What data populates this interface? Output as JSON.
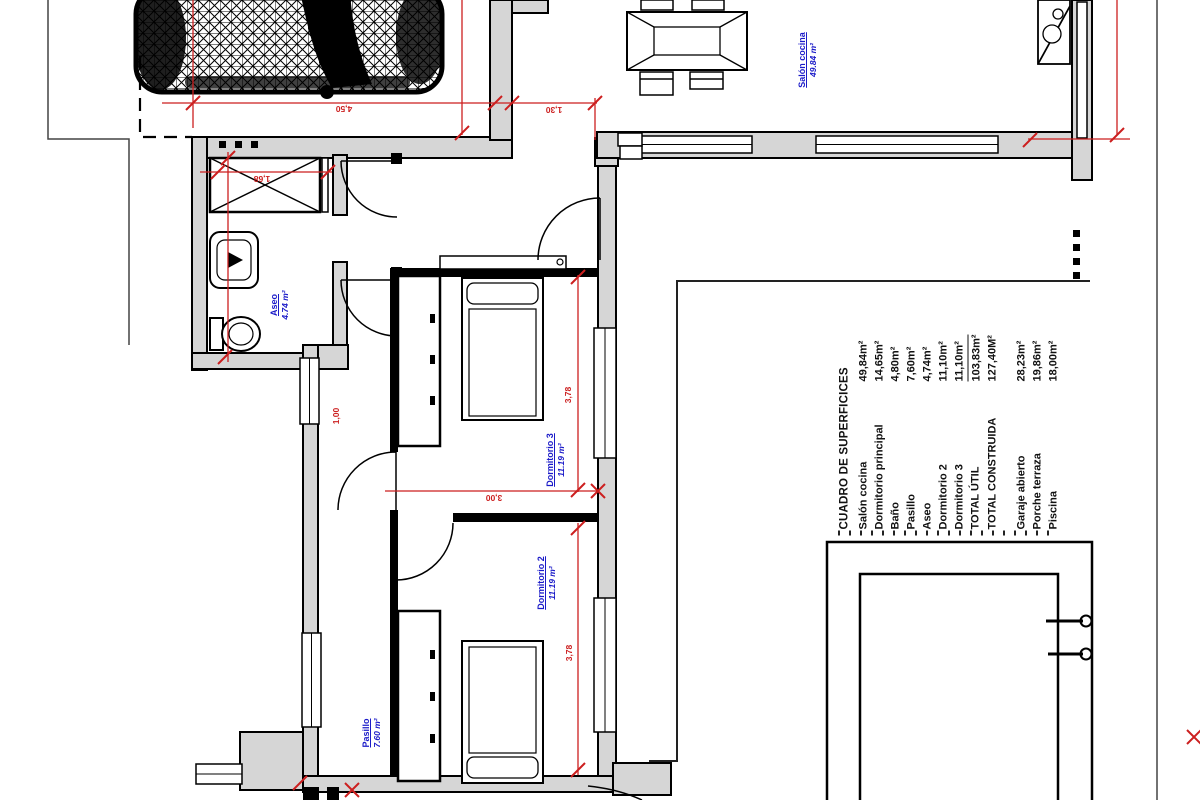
{
  "plan": {
    "rooms": {
      "salon": {
        "name": "Salón cocina",
        "area": "49.84 m²"
      },
      "aseo": {
        "name": "Aseo",
        "area": "4.74 m²"
      },
      "dorm3": {
        "name": "Dormitorio 3",
        "area": "11.19 m²"
      },
      "dorm2": {
        "name": "Dormitorio 2",
        "area": "11.19 m²"
      },
      "pasillo": {
        "name": "Pasillo",
        "area": "7.60 m²"
      }
    },
    "dims": {
      "garage_width": "4,50",
      "entry_gap": "1,30",
      "shower_width": "1,68",
      "dorm3_depth": "3,78",
      "dorm3_width": "3,00",
      "dorm2_depth": "3,78",
      "window_width": "1,00"
    },
    "colors": {
      "wall_fill": "#d6d6d6",
      "line_black": "#000000",
      "dimension_red": "#cc1f1f",
      "label_blue": "#1a1ac8"
    }
  },
  "areas_table": {
    "title": "CUADRO DE SUPERFICICES",
    "rows": [
      {
        "label": "Salón cocina",
        "value": "49,84m²"
      },
      {
        "label": "Dormitorio principal",
        "value": "14,65m²"
      },
      {
        "label": "Baño",
        "value": "4,80m²"
      },
      {
        "label": "Pasillo",
        "value": "7,60m²"
      },
      {
        "label": "Aseo",
        "value": "4,74m²"
      },
      {
        "label": "Dormitorio 2",
        "value": "11,10m²"
      },
      {
        "label": "Dormitorio 3",
        "value": "11,10m²"
      },
      {
        "label": "TOTAL ÚTIL",
        "value": "103,83m²"
      },
      {
        "label": "TOTAL CONSTRUIDA",
        "value": "127,40M²"
      },
      {
        "label": "Garaje abierto",
        "value": "28,23m²"
      },
      {
        "label": "Porche terraza",
        "value": "19,86m²"
      },
      {
        "label": "Piscina",
        "value": "18,00m²"
      }
    ]
  }
}
